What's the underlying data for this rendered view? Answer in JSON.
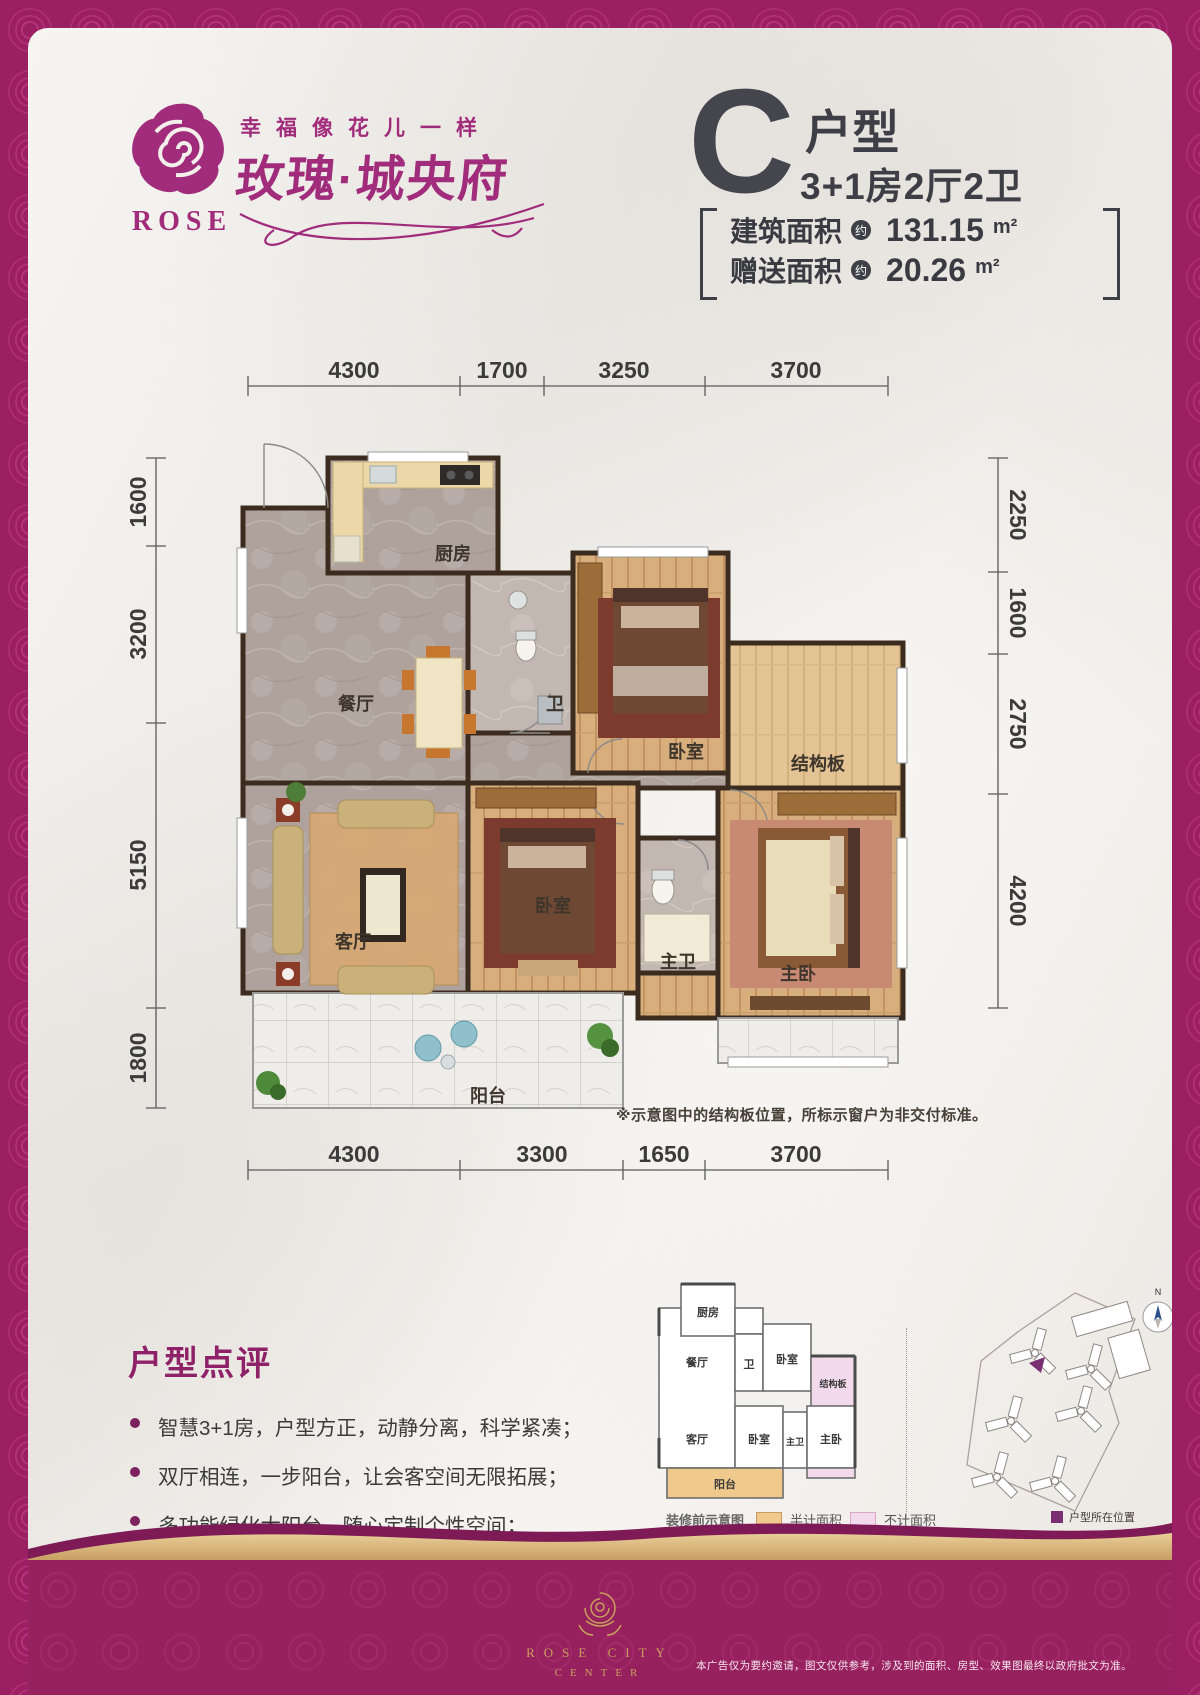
{
  "brand": {
    "rose_text": "ROSE",
    "tagline": "幸福像花儿一样",
    "name": "玫瑰·城央府"
  },
  "unit": {
    "letter": "C",
    "type_label": "户型",
    "layout": "3+1房2厅2卫",
    "areas": [
      {
        "label": "建筑面积",
        "approx": "约",
        "value": "131.15",
        "unit": "m²"
      },
      {
        "label": "赠送面积",
        "approx": "约",
        "value": "20.26",
        "unit": "m²"
      }
    ]
  },
  "plan": {
    "dims": {
      "top": [
        "4300",
        "1700",
        "3250",
        "3700"
      ],
      "bottom": [
        "4300",
        "3300",
        "1650",
        "3700"
      ],
      "left": [
        "1600",
        "3200",
        "5150",
        "1800"
      ],
      "right": [
        "2250",
        "1600",
        "2750",
        "4200"
      ]
    },
    "rooms": {
      "kitchen": "厨房",
      "dining": "餐厅",
      "bath": "卫",
      "bedroom_top": "卧室",
      "slab": "结构板",
      "living": "客厅",
      "bedroom_bottom": "卧室",
      "master_bath": "主卫",
      "master_bedroom": "主卧",
      "balcony": "阳台"
    },
    "note": "※示意图中的结构板位置，所标示窗户为非交付标准。"
  },
  "review": {
    "title": "户型点评",
    "bullets": [
      "智慧3+1房，户型方正，动静分离，科学紧凑；",
      "双厅相连，一步阳台，让会客空间无限拓展；",
      "多功能绿化大阳台，随心定制个性空间；",
      "主次卧朝南，阳光清风入怀，美景尽收眼底。"
    ]
  },
  "mini": {
    "caption": "装修前示意图",
    "legend_half": "半计面积",
    "legend_none": "不计面积"
  },
  "site": {
    "compass": "N",
    "legend": "户型所在位置"
  },
  "footer": {
    "logo_line1": "ROSE CITY",
    "logo_line2": "CENTER",
    "disclaimer": "本广告仅为要约邀请，图文仅供参考，涉及到的面积、房型、效果图最终以政府批文为准。"
  },
  "colors": {
    "brand": "#9E2168",
    "gold": "#C9A05C",
    "half_area": "#F0C98C",
    "no_area": "#F3D9EC",
    "dark_text": "#3E3E46"
  }
}
